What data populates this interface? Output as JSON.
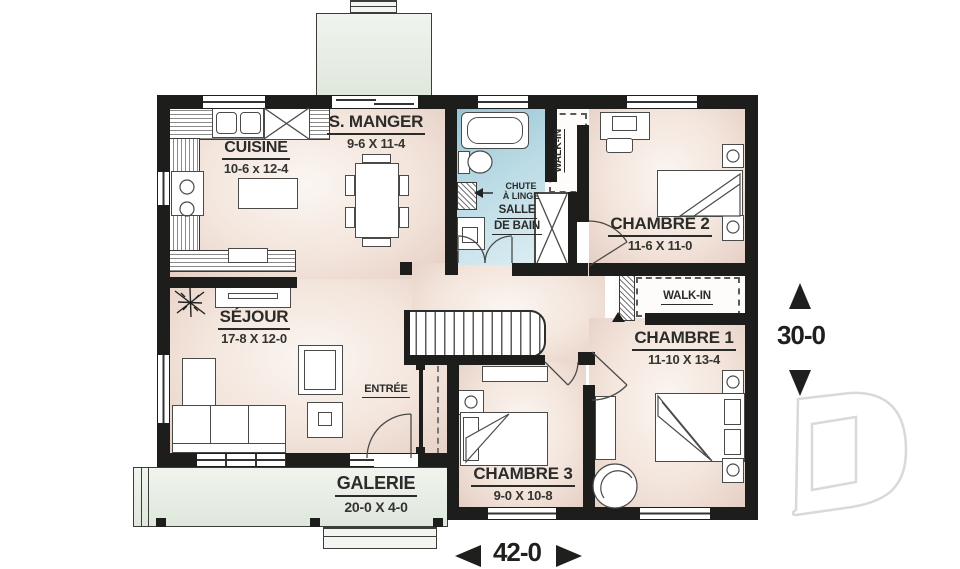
{
  "plan_title": "floor-plan",
  "rooms": {
    "cuisine": {
      "name": "CUISINE",
      "dims": "10-6 x 12-4"
    },
    "smanger": {
      "name": "S. MANGER",
      "dims": "9-6 X 11-4"
    },
    "bain": {
      "line1": "SALLE",
      "line2": "DE BAIN"
    },
    "walkin_bain": {
      "name": "WALK-IN"
    },
    "chambre2": {
      "name": "CHAMBRE 2",
      "dims": "11-6 X 11-0"
    },
    "walkin_ch1": {
      "name": "WALK-IN"
    },
    "chambre1": {
      "name": "CHAMBRE 1",
      "dims": "11-10 X 13-4"
    },
    "sejour": {
      "name": "SÉJOUR",
      "dims": "17-8 X 12-0"
    },
    "entree": {
      "name": "ENTRÉE"
    },
    "chambre3": {
      "name": "CHAMBRE 3",
      "dims": "9-0 X 10-8"
    },
    "galerie": {
      "name": "GALERIE",
      "dims": "20-0 X 4-0"
    }
  },
  "annotations": {
    "chute_line1": "CHUTE",
    "chute_line2": "À LINGE"
  },
  "dimensions": {
    "overall_width": "42-0",
    "overall_depth": "30-0"
  },
  "watermark": {
    "label": "D"
  },
  "colors": {
    "wall": "#1d1d1b",
    "floor_light": "#fbf6f2",
    "floor_shade": "#e5cec3",
    "bath_blue": "#93c2d2",
    "deck_green": "#e7ece4",
    "label_text": "#2b2b29",
    "watermark_gray": "#d9d9d9"
  }
}
